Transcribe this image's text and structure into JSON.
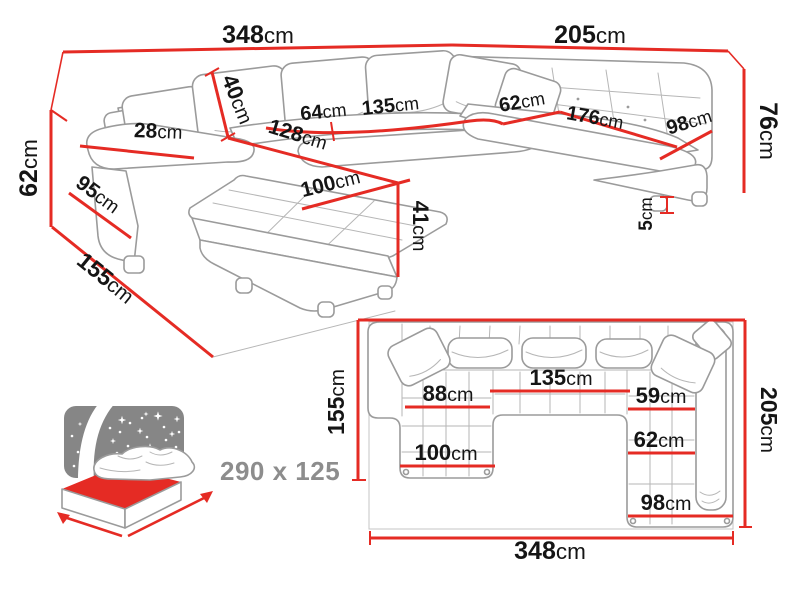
{
  "colors": {
    "dimension_red": "#e52b24",
    "line_gray": "#9b9b9b",
    "label_black": "#151515",
    "icon_gray": "#868686",
    "sleep_text_gray": "#8d8d8d"
  },
  "perspective_view": {
    "dimensions": {
      "total_width": {
        "value": "348",
        "unit": "cm"
      },
      "right_side_width": {
        "value": "205",
        "unit": "cm"
      },
      "back_cushion_height": {
        "value": "40",
        "unit": "cm"
      },
      "armrest_width": {
        "value": "28",
        "unit": "cm"
      },
      "armrest_height": {
        "value": "62",
        "unit": "cm"
      },
      "armrest_depth": {
        "value": "95",
        "unit": "cm"
      },
      "chaise_length": {
        "value": "155",
        "unit": "cm"
      },
      "seat_front_length": {
        "value": "128",
        "unit": "cm"
      },
      "chaise_width": {
        "value": "100",
        "unit": "cm"
      },
      "seat_height": {
        "value": "41",
        "unit": "cm"
      },
      "seat_depth": {
        "value": "64",
        "unit": "cm"
      },
      "middle_seat_width": {
        "value": "135",
        "unit": "cm"
      },
      "right_seat_depth": {
        "value": "62",
        "unit": "cm"
      },
      "right_seat_length": {
        "value": "176",
        "unit": "cm"
      },
      "right_seat_width": {
        "value": "98",
        "unit": "cm"
      },
      "total_height": {
        "value": "76",
        "unit": "cm"
      },
      "feet_height": {
        "value": "5",
        "unit": "cm"
      }
    }
  },
  "plan_view": {
    "dimensions": {
      "total_width": {
        "value": "348",
        "unit": "cm"
      },
      "left_depth": {
        "value": "155",
        "unit": "cm"
      },
      "right_depth": {
        "value": "205",
        "unit": "cm"
      },
      "chaise_seat_width": {
        "value": "88",
        "unit": "cm"
      },
      "middle_seat_width": {
        "value": "135",
        "unit": "cm"
      },
      "corner_seat_depth": {
        "value": "59",
        "unit": "cm"
      },
      "right_seat_depth": {
        "value": "62",
        "unit": "cm"
      },
      "chaise_width": {
        "value": "100",
        "unit": "cm"
      },
      "right_section_width": {
        "value": "98",
        "unit": "cm"
      }
    }
  },
  "sleeping_area": {
    "label": "290 x 125"
  }
}
